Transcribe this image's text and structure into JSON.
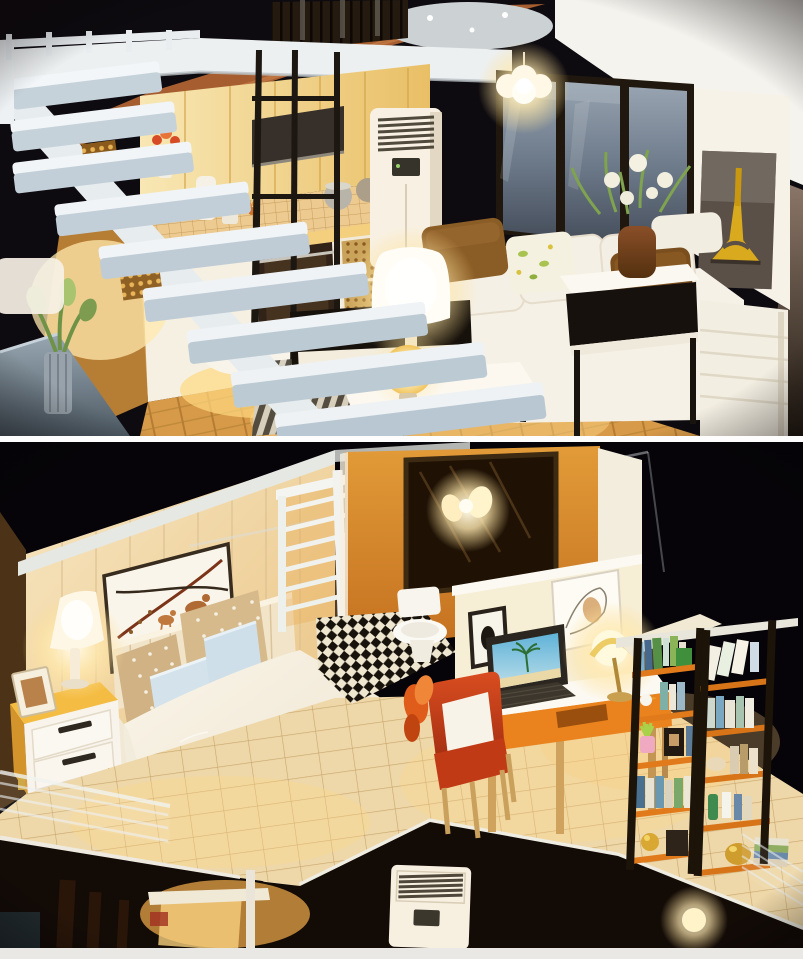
{
  "meta": {
    "type": "photo-collage",
    "subject": "DIY miniature dollhouse loft interior, two stacked warm-lit photos",
    "width": 803,
    "height": 959
  },
  "photos": [
    {
      "id": "living-room",
      "label": "Miniature loft living room: white open staircase, kitchen with cabinets and range hood, black frame partition, flower vase table, air conditioner, pendant light, dark windows, Eiffel Tower poster, white sofa with brown pillows, glowing table lamps, coffee table, striped rug",
      "objects": [
        "white-staircase",
        "stair-railing",
        "kitchen-upper-cabinets",
        "range-hood",
        "backsplash",
        "kitchen-counter",
        "counter-props",
        "oven",
        "rattan-drawers",
        "wood-floor",
        "black-frame-partition",
        "side-table",
        "flower-vase",
        "air-conditioner",
        "pendant-light",
        "window-wall",
        "eiffel-tower-poster",
        "white-sofa",
        "brown-pillow-left",
        "floral-pillow",
        "brown-pillow-right",
        "tv-console",
        "striped-rug",
        "coffee-table",
        "shade-lamp",
        "orb-lamp",
        "potted-plant",
        "base-platform",
        "roof-tiles",
        "foil-pile",
        "green-ball-ornament",
        "dark-slats"
      ]
    },
    {
      "id": "bedroom",
      "label": "Miniature loft bedroom: deer wall art, bed with polka-dot and blue pillows and tan throw, yellow-white nightstand with glowing lamp, houndstooth rugs, white railing screen, bathroom with mirror sconce toilet and checkerboard floor, desk with laptop and lamp, red armchair, orange-shelved bookcase, glass balustrades, lower floor with air conditioner and bulb",
      "objects": [
        "roof-slab",
        "acrylic-cover-edge",
        "plank-wall",
        "deer-wall-art",
        "headboard",
        "polka-dot-pillows",
        "blue-pillows",
        "duvet",
        "tan-throw",
        "nightstand",
        "bedside-lamp",
        "photo-frame",
        "houndstooth-rug-left",
        "houndstooth-rug-right",
        "white-railing-screen",
        "corner-greenery",
        "bathroom-wall",
        "bathroom-mirror",
        "wall-sconce",
        "toilet",
        "checkerboard-floor",
        "study-wall",
        "horse-poster",
        "framed-poster",
        "desk",
        "laptop",
        "desk-lamp",
        "red-armchair",
        "orange-decor",
        "bookshelf",
        "succulent-pot",
        "white-bird",
        "gold-trinkets",
        "glass-balustrade-left",
        "glass-balustrade-right",
        "floor-opening",
        "railing-post",
        "lower-air-conditioner",
        "lower-light-bulb",
        "lower-beams"
      ]
    }
  ],
  "palette": {
    "background_dark": "#0e0b10",
    "night_black": "#060408",
    "divider_white": "#fdfdfd",
    "footer_strip": "#e9e8e4",
    "warm_wall": "#f2c469",
    "amber_deep": "#d88a2a",
    "lamp_glow": "#fff3cf",
    "wood_floor": "#d79a48",
    "stair_white": "#eef1f3",
    "sofa_white": "#f5f0e5",
    "pillow_brown": "#7a4e1d",
    "pillow_blue": "#d3e2ea",
    "pillow_tan": "#d0b284",
    "rug_red": "#8e2b1a",
    "rug_cream": "#f3e6cf",
    "chair_red": "#d0421e",
    "shelf_orange": "#e07a1b",
    "shelf_black": "#1c1309",
    "desk_orange": "#ea831d",
    "nightstand_yellow": "#f2b93e",
    "window_glass": "#6b7888",
    "checker_dark": "#17120c",
    "checker_light": "#efe6cf",
    "base_gray": "#8d9ba6",
    "eiffel_yellow": "#d9a91e"
  }
}
